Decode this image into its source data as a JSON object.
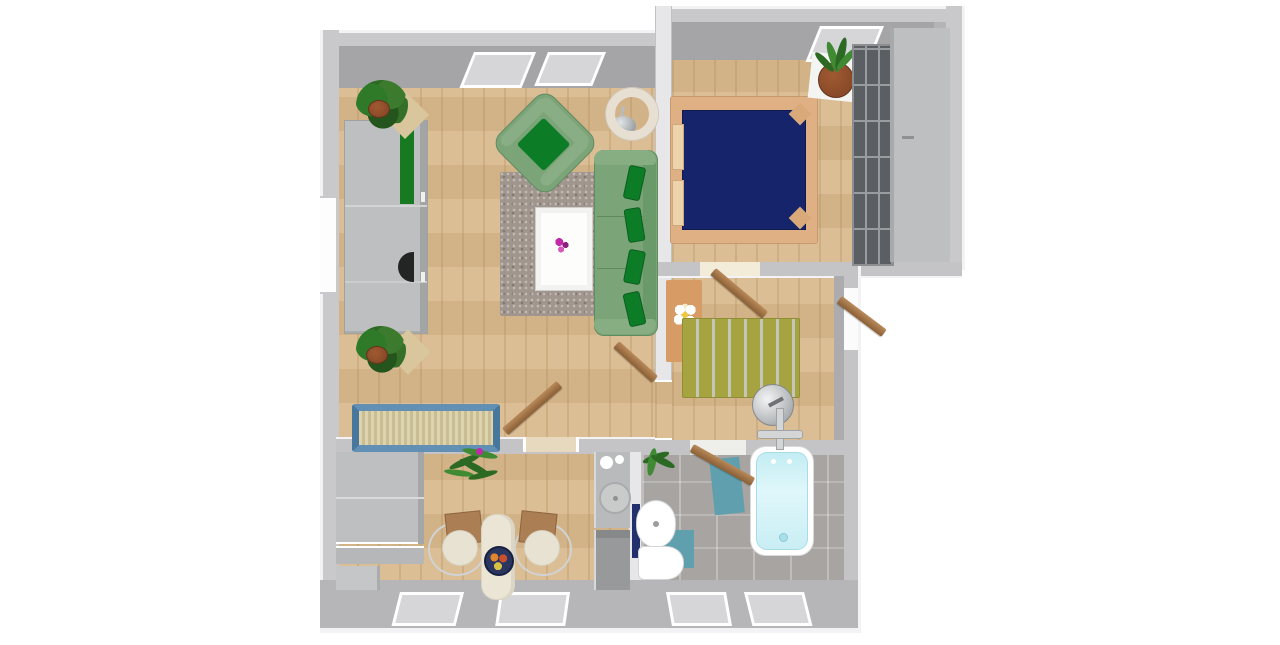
{
  "view": {
    "type": "3d-floorplan-top-down-render",
    "canvas": {
      "width": 1280,
      "height": 645
    },
    "background": "#ffffff",
    "visible_text": ""
  },
  "colors": {
    "wall_top": "#c9c9cc",
    "wall_face": "#a5a5a8",
    "wall_partition": "#e7e7e9",
    "wall_divider": "#c4c4c7",
    "wall_bottom": "#b6b6b9",
    "wall_edge": "#f3f3f5",
    "window_glass": "#d6d6d9",
    "window_frame": "#ffffff",
    "wood_floor": "#d9ba8e",
    "tile_floor": "#a7a4a1",
    "rug_taupe": "#a0968e",
    "rug_olive": "#a5a440",
    "rug_olive_stripe": "#c6c6b8",
    "rug_orange": "#d79b66",
    "sofa_green": "#7ba478",
    "sofa_green_dark": "#6a9a69",
    "pillow_green": "#0c7c27",
    "bed_navy": "#16256b",
    "bed_frame_tan": "#deb084",
    "pillow_tan": "#ecd3ab",
    "shelf_dark": "#5b5f63",
    "shelf_seam": "#9a9da0",
    "shelf_tan": "#d9c69c",
    "wardrobe_gray": "#bdbfc1",
    "wardrobe_green": "#177a20",
    "cabinet_gray": "#bdbfc0",
    "counter_dark": "#98999b",
    "steel_gray": "#c9cbcb",
    "table_cream": "#ebe5d5",
    "chair_seat_cream": "#e8e2d2",
    "chair_back_brown": "#ab7f53",
    "tub_white": "#ffffff",
    "tub_cyan": "#c3edf3",
    "mat_teal": "#60a0ae",
    "ceramic_white": "#ffffff",
    "radiator_navy": "#23306e",
    "door_wood": "#8a5f36",
    "door_wood_light": "#b98a5a",
    "plant_green": "#2f7a28",
    "plant_green_dark": "#24551c",
    "pot_terracotta": "#8a4a28",
    "flower_magenta": "#c12aa6",
    "flower_yellow": "#f0c83c",
    "fruit_orange": "#e0862c",
    "fruit_red": "#cc4f2c",
    "fruit_yellow": "#d8c244",
    "bowl_navy": "#2a3660",
    "lamp_cream": "#e7e0d2",
    "metal_gray": "#b9bcbf",
    "box_blue": "#6290b4",
    "box_fill": "#c9bd93"
  },
  "rooms": [
    {
      "id": "living-room",
      "floor": "wood",
      "furniture": [
        "wardrobe-with-green-door",
        "corner-plant-top",
        "corner-plant-bottom",
        "green-armchair",
        "taupe-rug",
        "white-coffee-table-with-flowers",
        "green-sofa-with-pillows",
        "ring-floor-lamp",
        "blue-storage-basket"
      ],
      "openings": [
        "two-top-windows",
        "left-wall-window",
        "door-to-kitchen",
        "door-to-hallway"
      ]
    },
    {
      "id": "bedroom",
      "floor": "wood",
      "furniture": [
        "double-bed-navy-cover",
        "potted-plant",
        "dark-shelf-unit",
        "gray-wardrobe"
      ],
      "openings": [
        "skylight-window",
        "door-to-hallway"
      ]
    },
    {
      "id": "hallway",
      "floor": "wood",
      "furniture": [
        "orange-rug-with-flower",
        "olive-striped-rug",
        "standing-fan"
      ],
      "openings": [
        "entrance-door",
        "door-to-bedroom",
        "door-to-bathroom",
        "door-to-living-room"
      ]
    },
    {
      "id": "kitchen",
      "floor": "wood",
      "furniture": [
        "cabinet-block",
        "low-cabinets",
        "hanging-plant",
        "cream-table",
        "fruit-bowl",
        "two-wire-chairs",
        "stove-counter",
        "sink",
        "lower-counter"
      ],
      "openings": [
        "two-bottom-windows",
        "door-to-living-room"
      ]
    },
    {
      "id": "bathroom",
      "floor": "tile",
      "furniture": [
        "bathtub",
        "wall-sink",
        "toilet",
        "navy-radiator",
        "teal-mat-large",
        "teal-mat-small",
        "potted-plant"
      ],
      "openings": [
        "two-bottom-windows",
        "door-to-hallway"
      ]
    }
  ]
}
